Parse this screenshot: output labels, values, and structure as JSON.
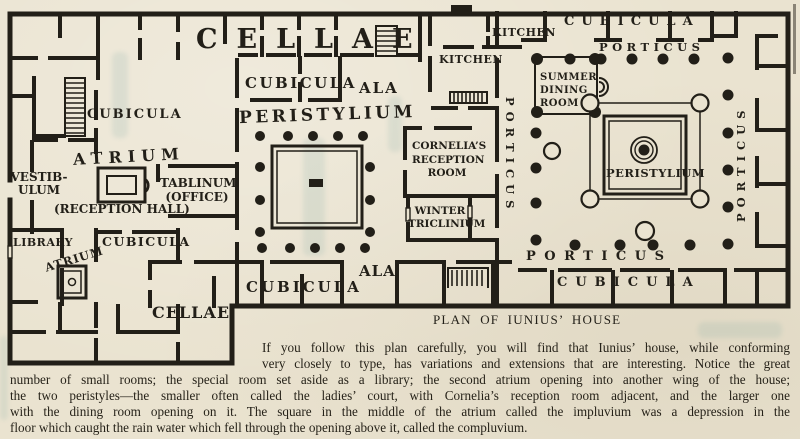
{
  "colors": {
    "paper": "#eae3d0",
    "ink": "#221f18",
    "ghost_tint": "#6fa09c"
  },
  "plan": {
    "labels": [
      {
        "id": "cellae-top",
        "text": "CELLAE"
      },
      {
        "id": "kitchen-upper",
        "text": "KITCHEN"
      },
      {
        "id": "cubicula-top-right",
        "text": "CUBICULA"
      },
      {
        "id": "porticus-top",
        "text": "PORTICUS"
      },
      {
        "id": "kitchen-lower",
        "text": "KITCHEN"
      },
      {
        "id": "cubicula-mid-top",
        "text": "CUBICULA"
      },
      {
        "id": "ala-top",
        "text": "ALA"
      },
      {
        "id": "peristylium-left",
        "text": "PERISTYLIUM"
      },
      {
        "id": "summer-dining-room",
        "text": "SUMMER\nDINING\nROOM"
      },
      {
        "id": "cubicula-left-upper",
        "text": "CUBICULA"
      },
      {
        "id": "atrium-main",
        "text": "ATRIUM"
      },
      {
        "id": "vestibulum",
        "text": "VESTIB-\nULUM"
      },
      {
        "id": "reception-hall",
        "text": "(RECEPTION HALL)"
      },
      {
        "id": "tablinum-office",
        "text": "TABLINUM\n(OFFICE)"
      },
      {
        "id": "cornelias-reception",
        "text": "CORNELIA’S\nRECEPTION\nROOM"
      },
      {
        "id": "winter-triclinium",
        "text": "WINTER\nTRICLINIUM"
      },
      {
        "id": "porticus-vertical-left",
        "text": "PORTICUS"
      },
      {
        "id": "peristylium-right",
        "text": "PERISTYLIUM"
      },
      {
        "id": "porticus-vertical-right",
        "text": "PORTICUS"
      },
      {
        "id": "library",
        "text": "LIBRARY"
      },
      {
        "id": "cubicula-left-lower",
        "text": "CUBICULA"
      },
      {
        "id": "atrium-small",
        "text": "ATRIUM"
      },
      {
        "id": "cellae-bottom",
        "text": "CELLAE"
      },
      {
        "id": "cubicula-bottom-mid",
        "text": "CUBICULA"
      },
      {
        "id": "ala-bottom",
        "text": "ALA"
      },
      {
        "id": "porticus-bottom",
        "text": "PORTICUS"
      },
      {
        "id": "cubicula-bottom-right",
        "text": "CUBICULA"
      }
    ]
  },
  "caption": {
    "text": "PLAN OF IUNIUS’ HOUSE"
  },
  "paragraph": {
    "lines": [
      "If you follow this plan carefully, you will find that Iunius’ house, while conforming",
      "very closely to type, has variations and extensions that are interesting.  Notice the great",
      "number of small rooms; the special room set aside as a library; the second atrium opening into another wing of the house;",
      "the two peristyles—the smaller often called the ladies’ court, with Cornelia’s reception room adjacent, and the larger one",
      "with the dining room opening on it.  The square in the middle of the atrium called the impluvium was a depression in the",
      "floor which caught the rain water which fell through the opening above it, called the compluvium."
    ]
  }
}
